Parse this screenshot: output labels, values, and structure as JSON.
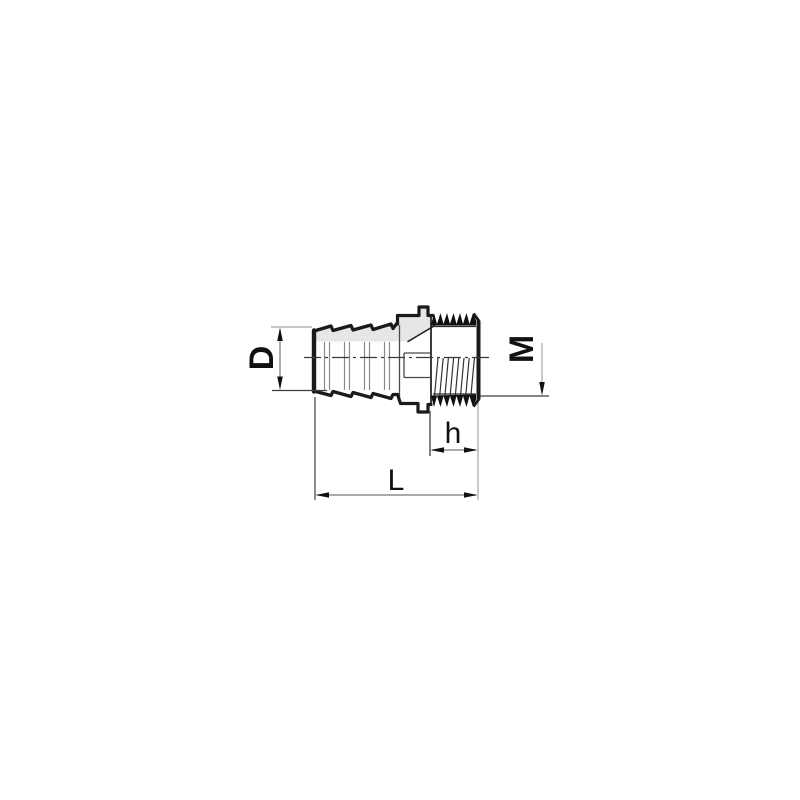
{
  "drawing": {
    "description": "Side elevation technical drawing of a hose barb to male threaded adapter fitting",
    "labels": {
      "barb_diameter": "D",
      "thread_size": "M",
      "thread_length": "h",
      "overall_length": "L"
    },
    "colors": {
      "outline": "#1a1a1a",
      "shading": "#e6e6e8",
      "dim_dark": "#3f3f3f",
      "dim_light": "#a6a6a6",
      "dim_mid": "#777777",
      "background": "#ffffff"
    }
  }
}
